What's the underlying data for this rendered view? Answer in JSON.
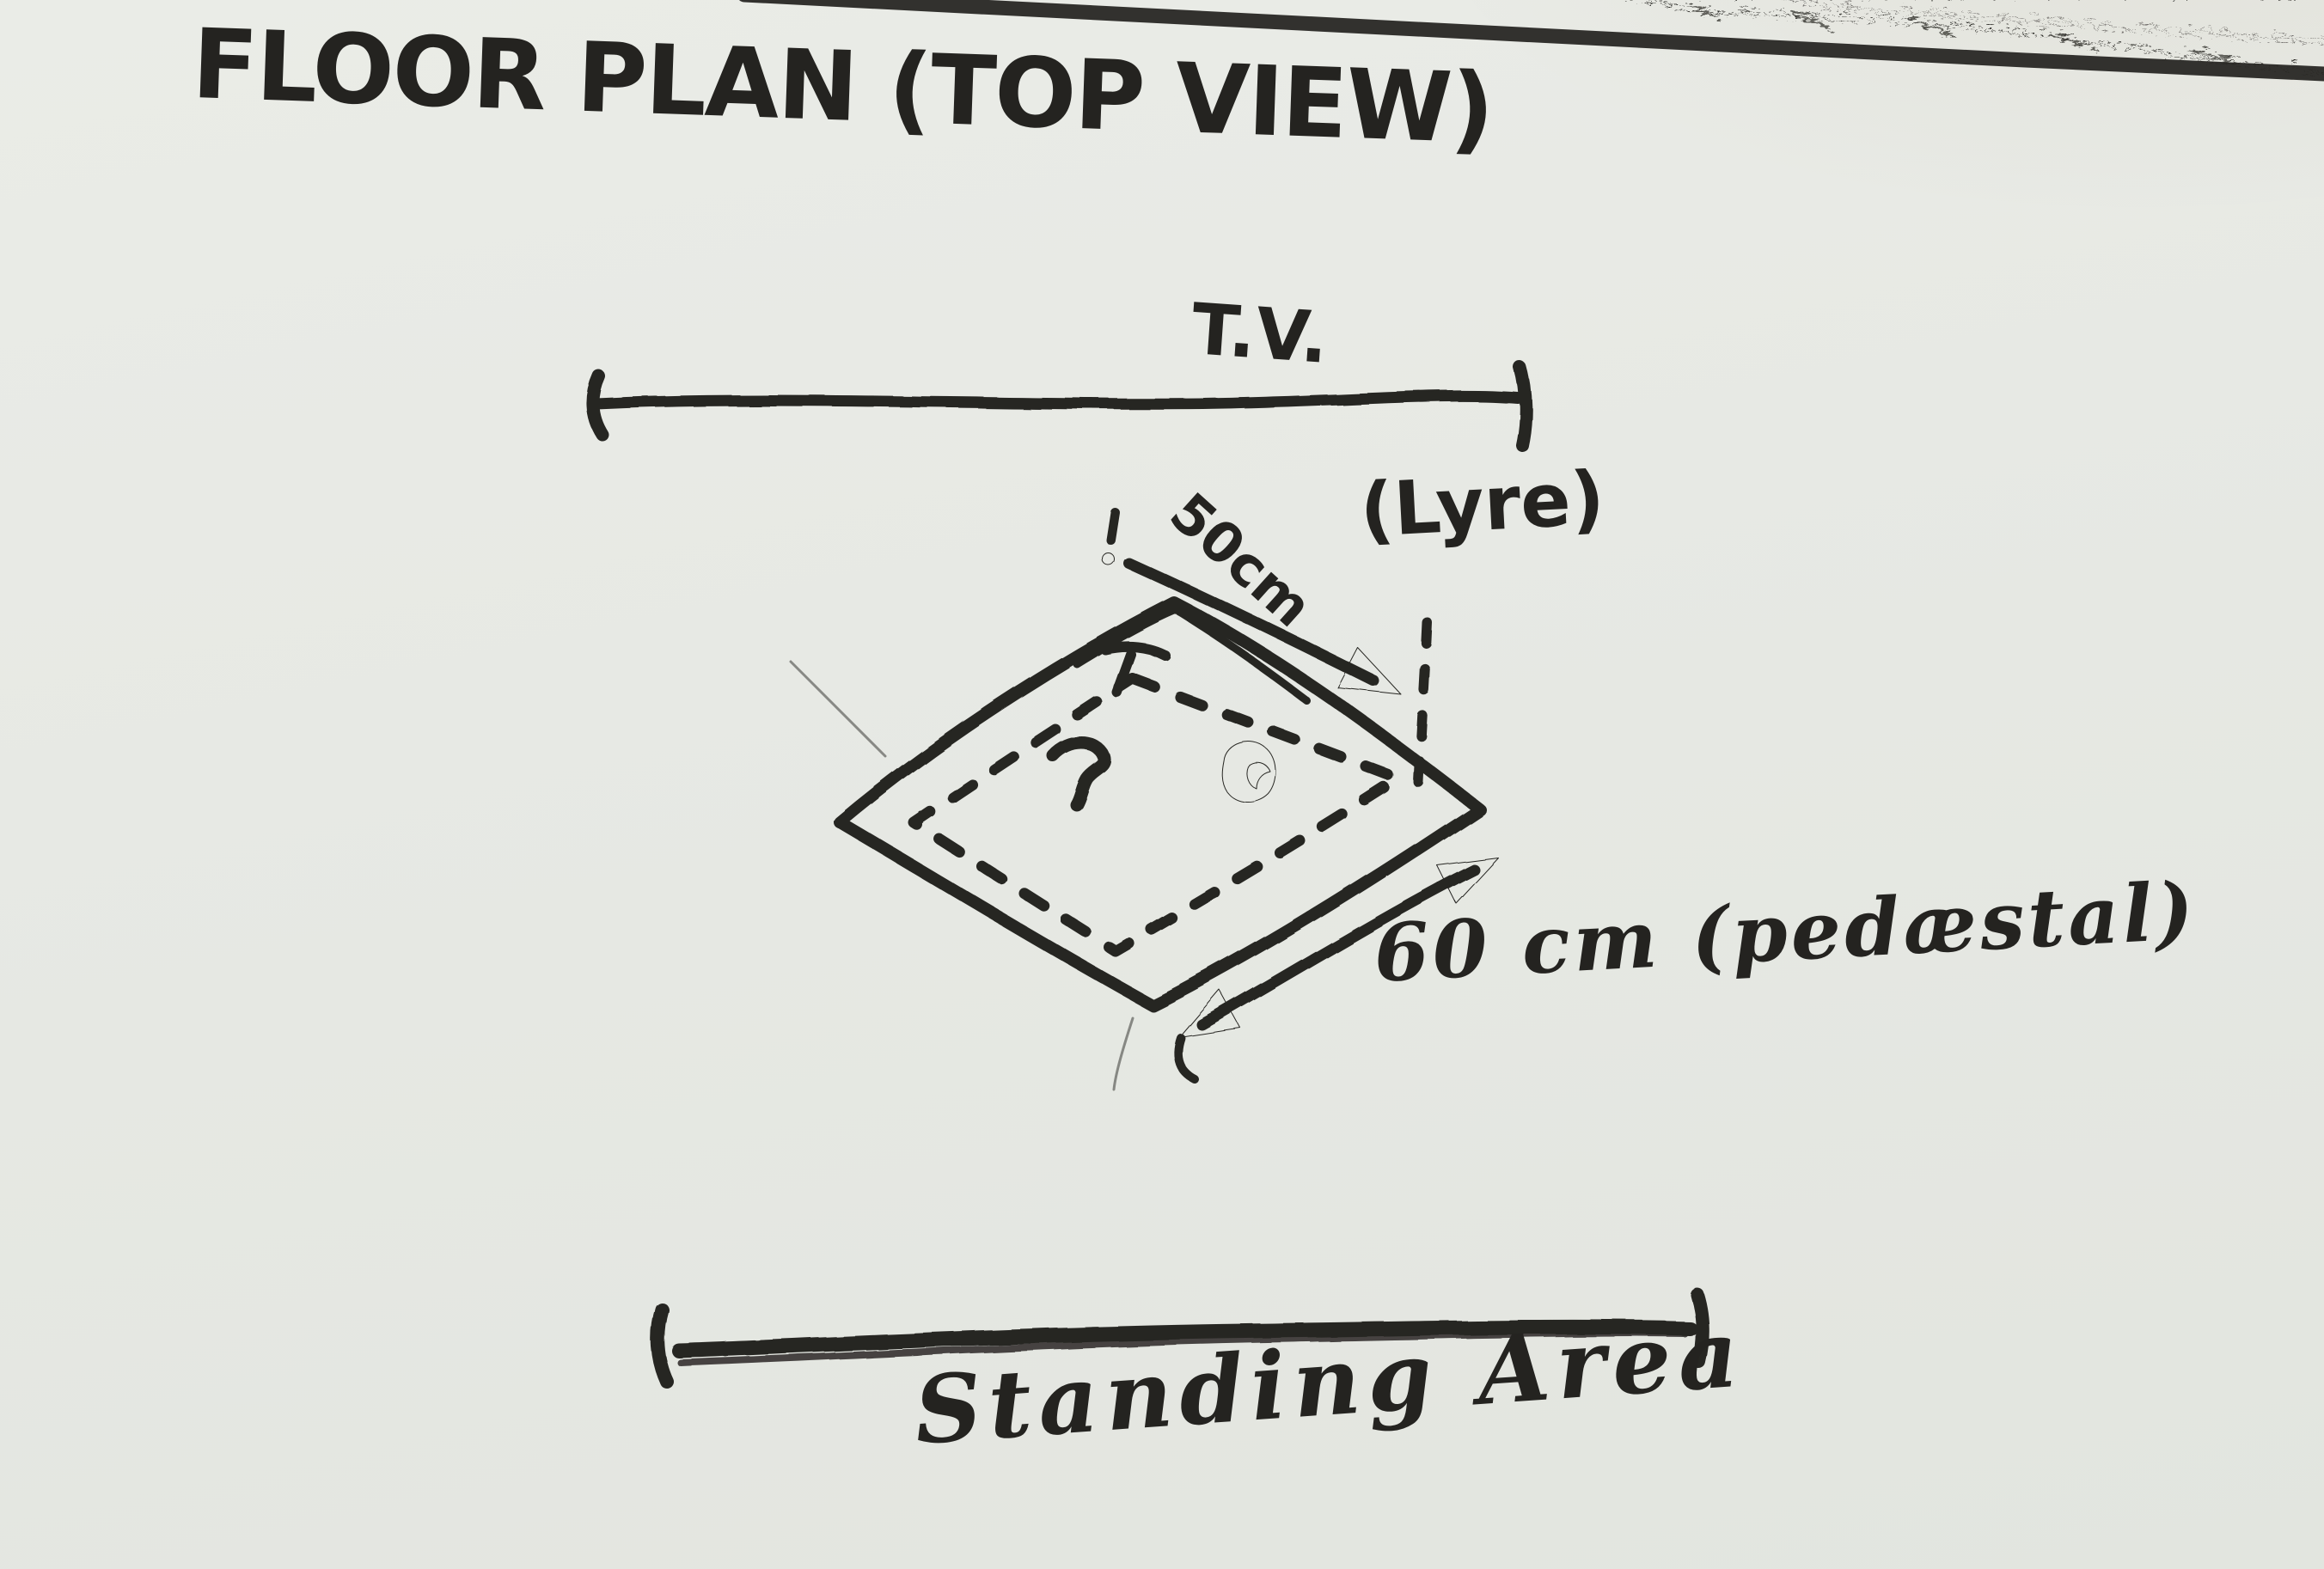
{
  "title": "FLOOR PLAN (TOP VIEW)",
  "labels": {
    "tv": "T.V.",
    "lyre_dimension": "50cm",
    "lyre": "(Lyre)",
    "pedestal_dimension": "60 cm (pedæstal)",
    "standing_area": "Standing Area"
  },
  "diagram": {
    "type": "hand-drawn floor plan sketch, top view",
    "elements": [
      "tv-wall dimension line at top",
      "solid diamond = pedestal (60 cm per side)",
      "dashed inner diamond = lyre footprint (50cm per side)",
      "standing area dimension line at bottom"
    ]
  },
  "colors": {
    "paper": "#e7e9e4",
    "ink": "#282724",
    "page_border_line": "#3a3d40",
    "carpet": "#a3723a"
  }
}
